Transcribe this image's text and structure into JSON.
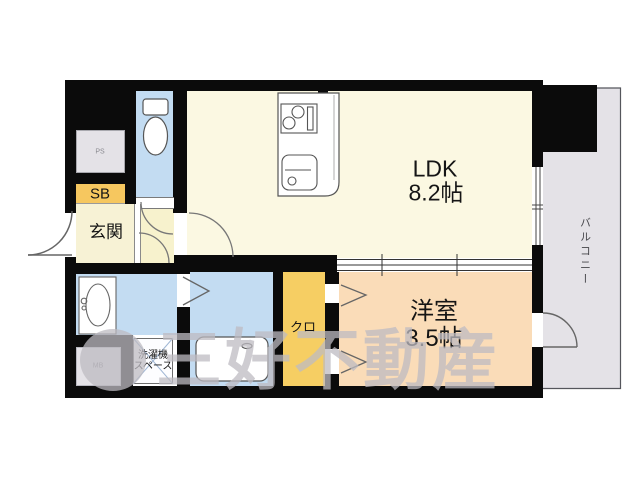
{
  "colors": {
    "wall": "#0b0b0b",
    "cream": "#fbf8e2",
    "entry": "#f7f2d5",
    "hall": "#f7f2cd",
    "blue": "#c3dcf2",
    "orange": "#f6c75f",
    "closet": "#f6ce63",
    "peach": "#fadcb8",
    "gray": "#e4e2e7",
    "outline": "#555555",
    "watermark": "rgba(189,187,193,0.75)"
  },
  "floorplan": {
    "ldk": {
      "name": "LDK",
      "size": "8.2帖"
    },
    "western_room": {
      "name": "洋室",
      "size": "3.5帖"
    },
    "entrance": {
      "name": "玄関"
    },
    "shoe_box": {
      "name": "SB"
    },
    "closet": {
      "name": "クロ"
    },
    "washer_space": {
      "line1": "洗濯機",
      "line2": "スペース"
    },
    "balcony": {
      "name": "バルコニー"
    },
    "pipe_space": {
      "name": "PS"
    },
    "meter_box": {
      "name": "MB"
    }
  },
  "watermark": {
    "brand": "三好不動産"
  }
}
